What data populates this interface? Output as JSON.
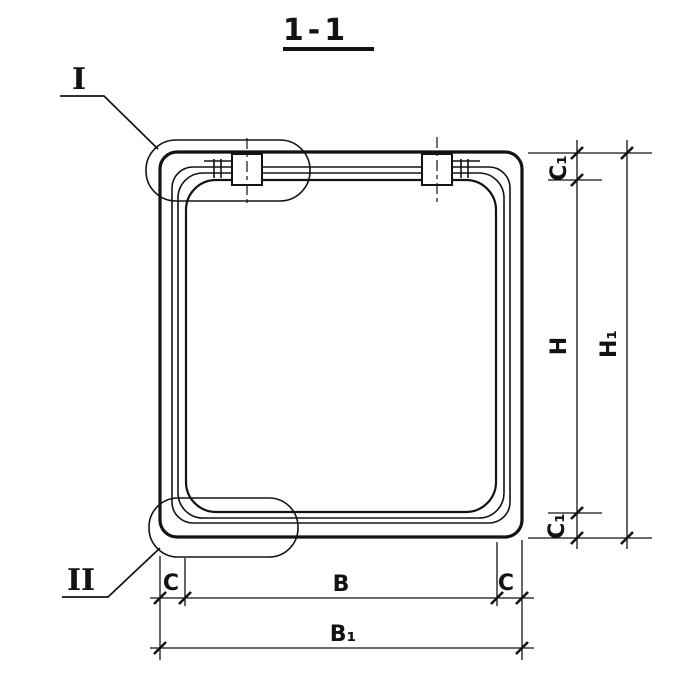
{
  "title": {
    "text": "1-1"
  },
  "details": {
    "top_callout": "I",
    "bottom_callout": "II"
  },
  "dimensions": {
    "vertical": {
      "c1_top": "C₁",
      "h": "H",
      "h1": "H₁",
      "c1_bottom": "C₁"
    },
    "horizontal": {
      "c_left": "C",
      "b": "B",
      "c_right": "C",
      "b1": "B₁"
    }
  },
  "colors": {
    "ink": "#131313",
    "paper": "#ffffff"
  }
}
